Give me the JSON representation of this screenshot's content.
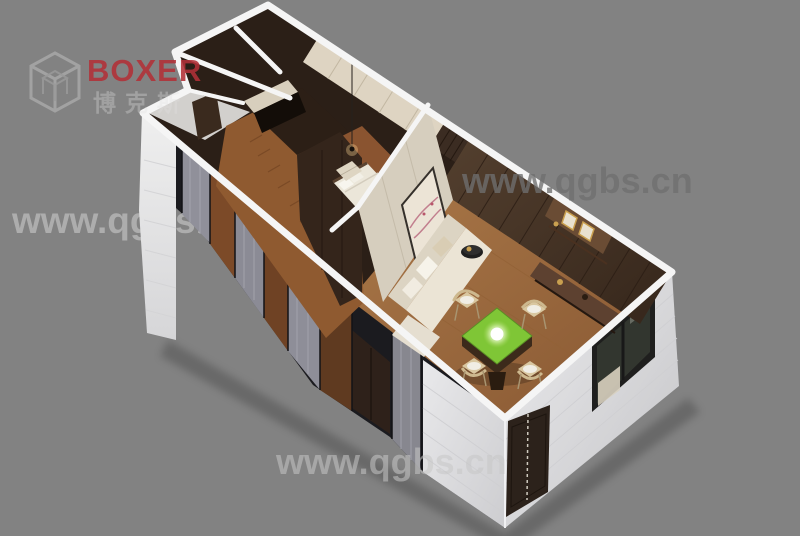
{
  "scene": {
    "description": "3D isometric cutaway rendering of a prefab container-house interior: entry hall and bathrooms at the far end, wardrobe corridor with parquet floor and gray curtain glass wall, bedroom with pendant lamp, and a mahjong/living room with cream sofa, wall painting, walnut plank feature wall and a green-top mahjong table with four chairs; white corrugated exterior walls with a door and window",
    "background_color": "#828282"
  },
  "logo": {
    "brand": "BOXER",
    "subtext": "博克斯",
    "brand_color": "#b23138",
    "icon": "cube-logo-icon"
  },
  "watermark": {
    "text": "www.qgbs.cn"
  },
  "palette": {
    "wall_top_white": "#f5f5f5",
    "facade_light": "#e8e8ea",
    "walnut_dark": "#33241a",
    "cream_wall": "#d6cebe",
    "floor_wood": "#8f5a30",
    "mahjong_green": "#7fc636",
    "curtain_gray": "#90909a",
    "sofa_cream": "#ebe4d5",
    "gold_accent": "#c9a050"
  }
}
